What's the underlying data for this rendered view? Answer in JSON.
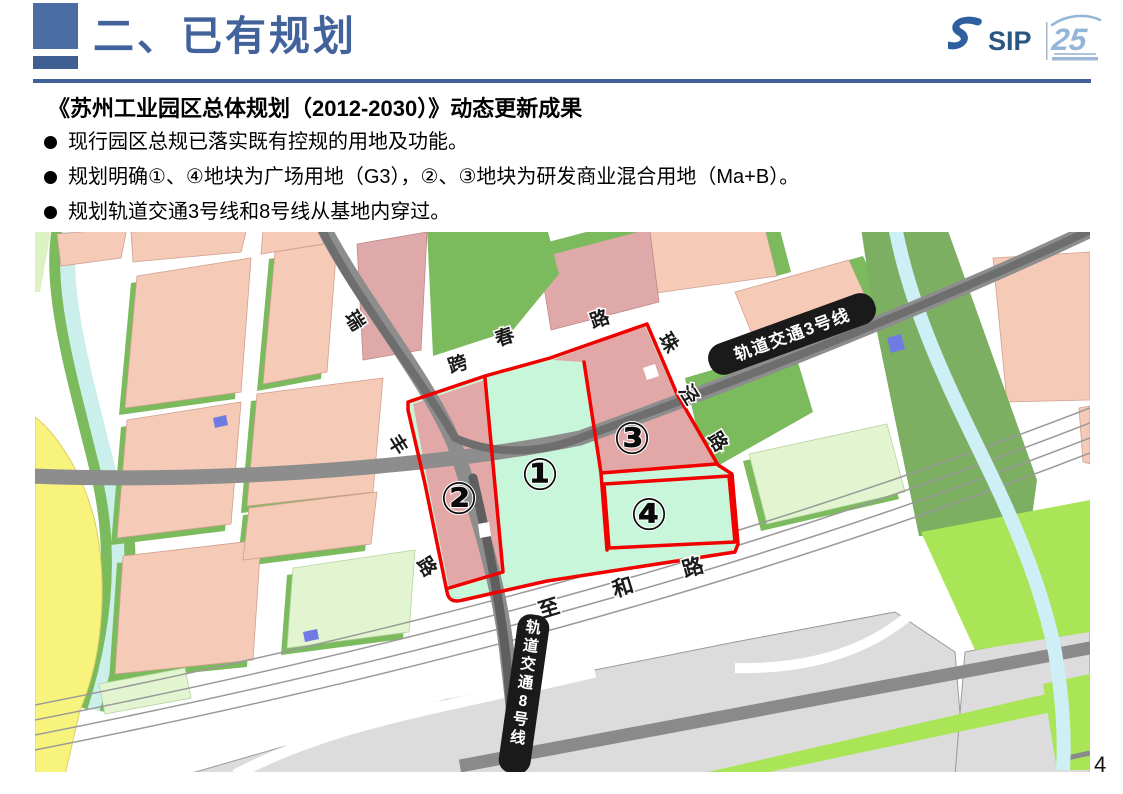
{
  "header": {
    "title": "二、已有规划",
    "logo_sip": "SIP",
    "logo_anniversary": "25"
  },
  "content": {
    "heading": "《苏州工业园区总体规划（2012-2030）》动态更新成果",
    "bullets": [
      "现行园区总规已落实既有控规的用地及功能。",
      "规划明确①、④地块为广场用地（G3），②、③地块为研发商业混合用地（Ma+B）。",
      "规划轨道交通3号线和8号线从基地内穿过。"
    ]
  },
  "map": {
    "rail_line_3_label": "轨道交通3号线",
    "rail_line_8_label": "轨道交通8号线",
    "road_labels": {
      "rui": "瑞",
      "kuachun": [
        "跨",
        "春",
        "路"
      ],
      "zhujing": [
        "珠",
        "泾",
        "路"
      ],
      "feng": [
        "丰",
        "路"
      ],
      "zhihe": [
        "至",
        "和",
        "路"
      ]
    },
    "parcels": [
      {
        "number": "①"
      },
      {
        "number": "②"
      },
      {
        "number": "③"
      },
      {
        "number": "④"
      }
    ]
  },
  "page_number": "4",
  "colors": {
    "accent_blue": "#42629B",
    "red_boundary": "#F20000",
    "mint_parcel": "#C8F6DA",
    "rose_parcel": "#E2A8A8",
    "pink_parcel": "#F5CAB6",
    "rail_banner": "#1A1A1A"
  }
}
